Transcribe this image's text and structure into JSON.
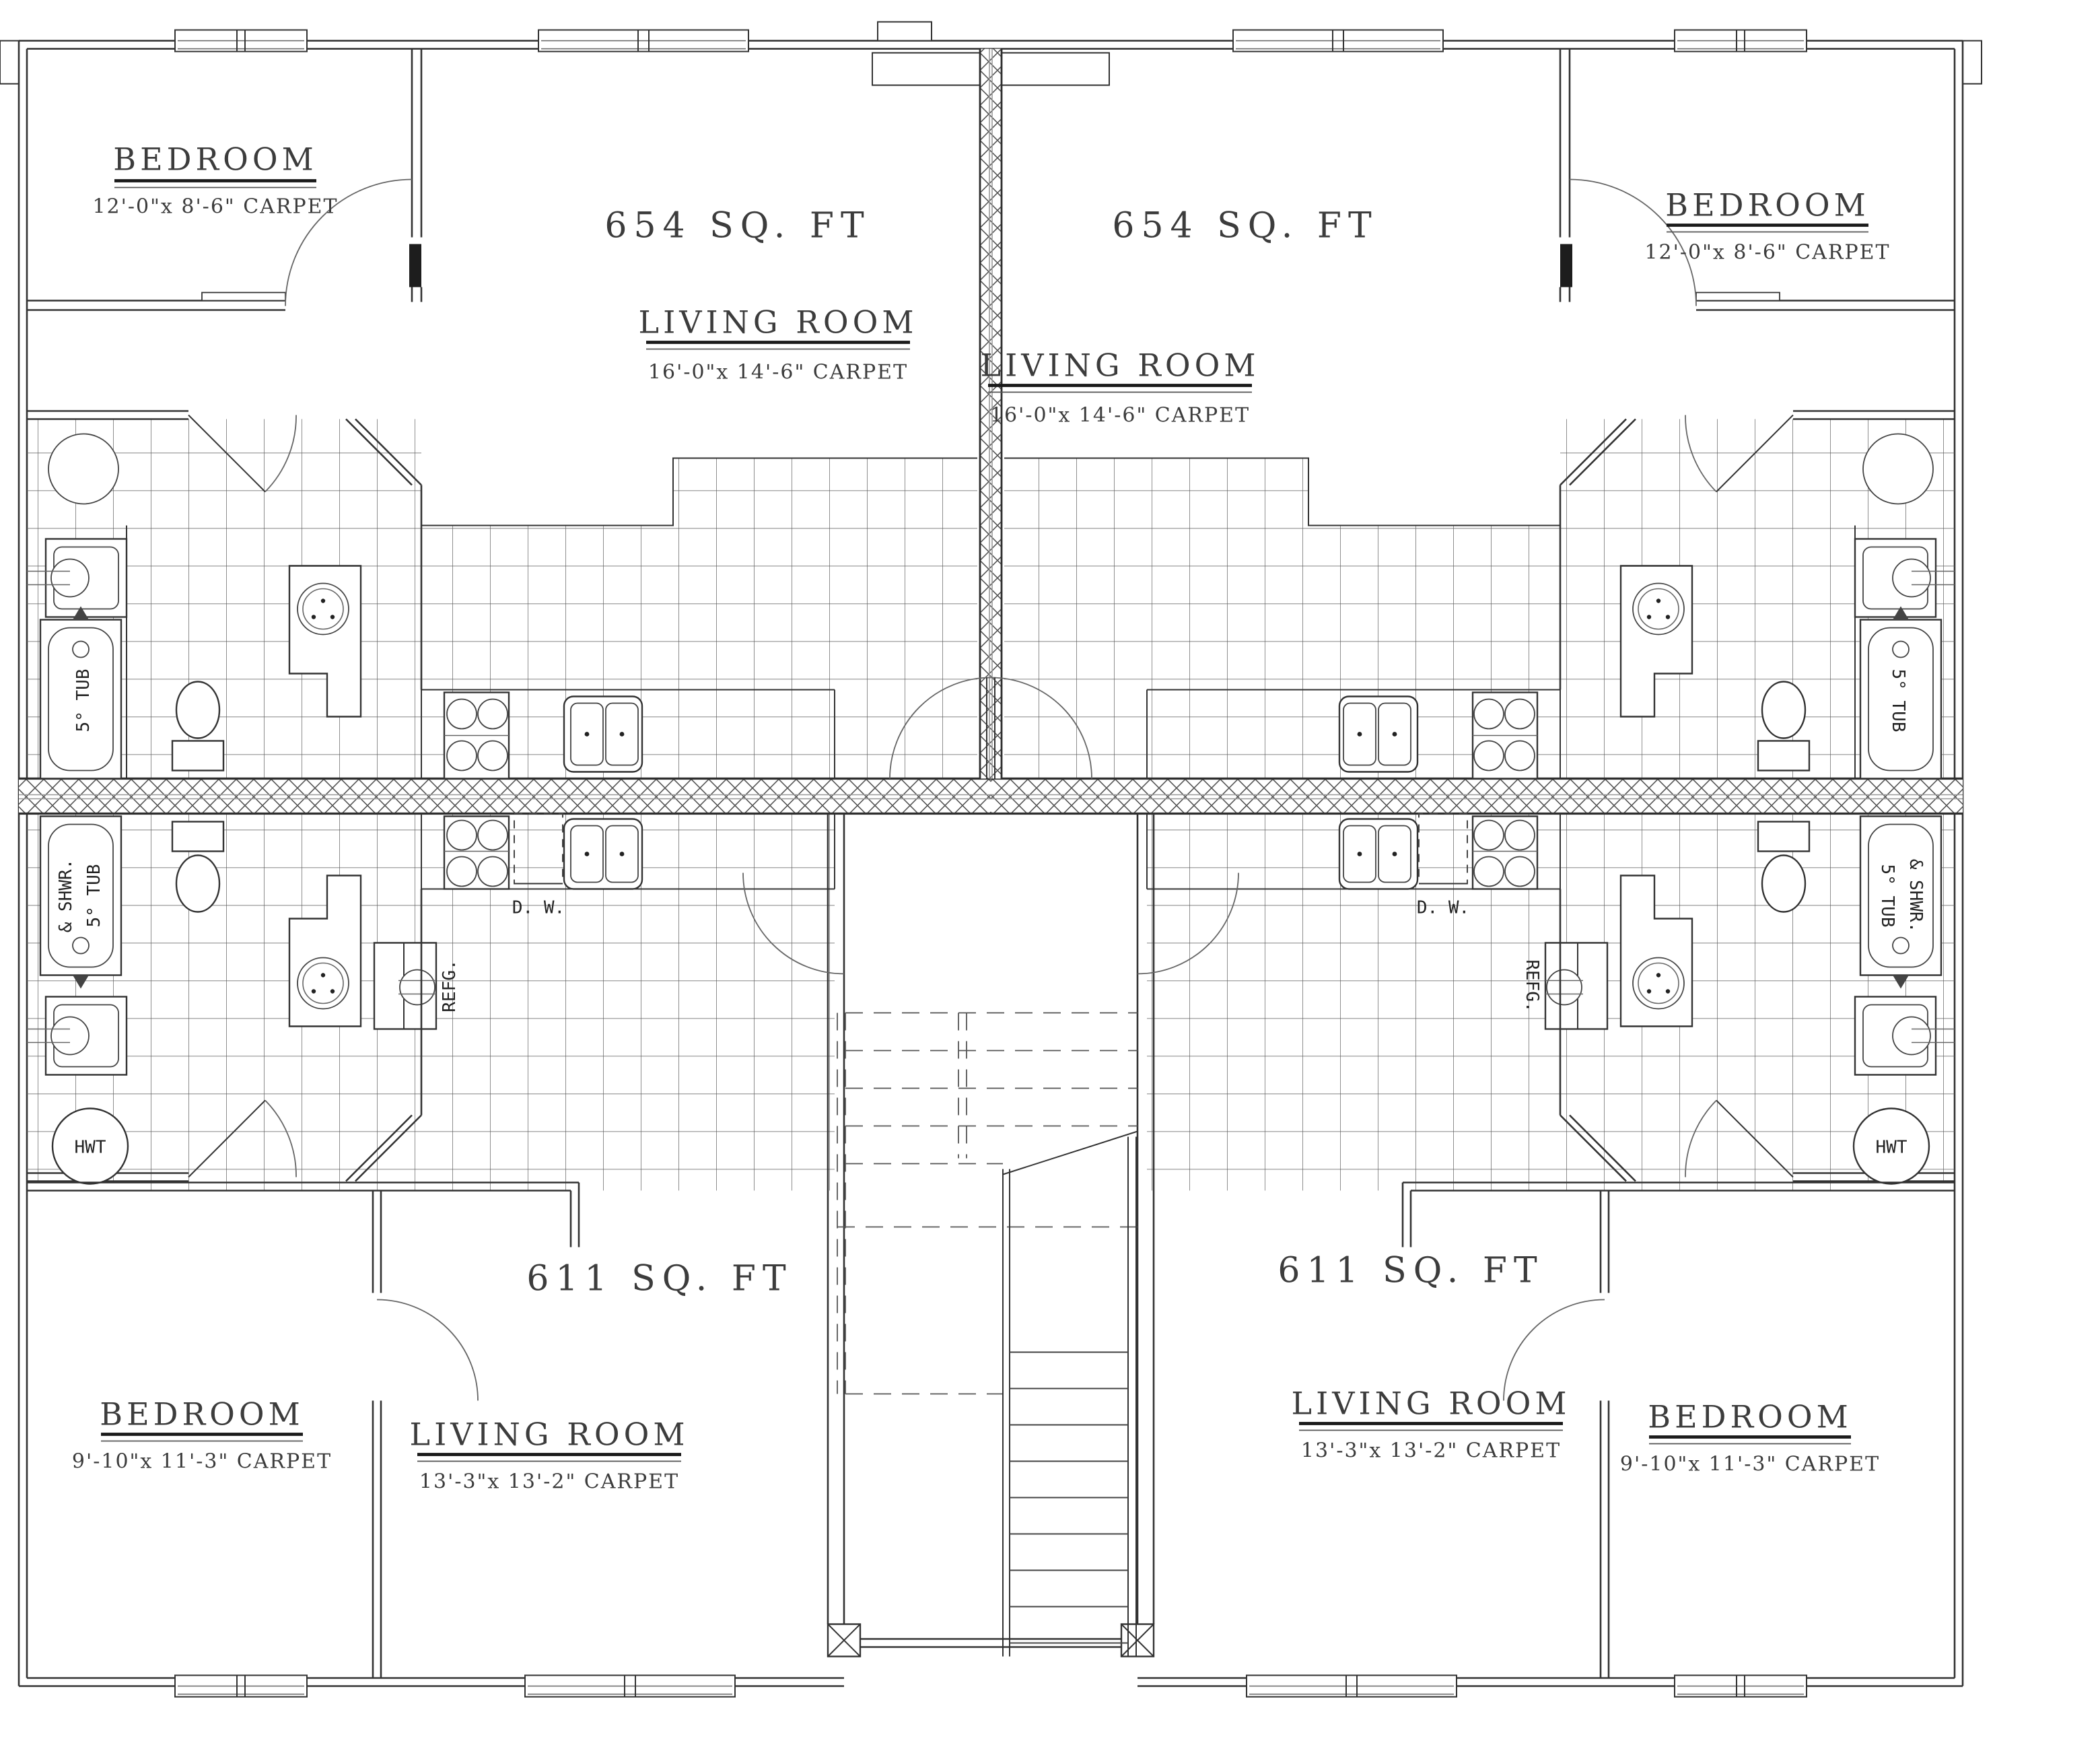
{
  "plan": {
    "upper_left": {
      "area": "654 SQ. FT",
      "bedroom_name": "BEDROOM",
      "bedroom_dims": "12'-0\"x 8'-6\" CARPET",
      "living_name": "LIVING ROOM",
      "living_dims": "16'-0\"x 14'-6\" CARPET"
    },
    "upper_right": {
      "area": "654 SQ. FT",
      "bedroom_name": "BEDROOM",
      "bedroom_dims": "12'-0\"x 8'-6\" CARPET",
      "living_name": "LIVING ROOM",
      "living_dims": "16'-0\"x 14'-6\" CARPET"
    },
    "lower_left": {
      "area": "611 SQ. FT",
      "bedroom_name": "BEDROOM",
      "bedroom_dims": "9'-10\"x 11'-3\" CARPET",
      "living_name": "LIVING ROOM",
      "living_dims": "13'-3\"x 13'-2\" CARPET"
    },
    "lower_right": {
      "area": "611 SQ. FT",
      "bedroom_name": "BEDROOM",
      "bedroom_dims": "9'-10\"x 11'-3\" CARPET",
      "living_name": "LIVING ROOM",
      "living_dims": "13'-3\"x 13'-2\" CARPET"
    },
    "fixtures": {
      "tub": "5° TUB",
      "shwr": "& SHWR.",
      "dw": "D. W.",
      "refg": "REFG.",
      "hwt": "HWT"
    }
  }
}
